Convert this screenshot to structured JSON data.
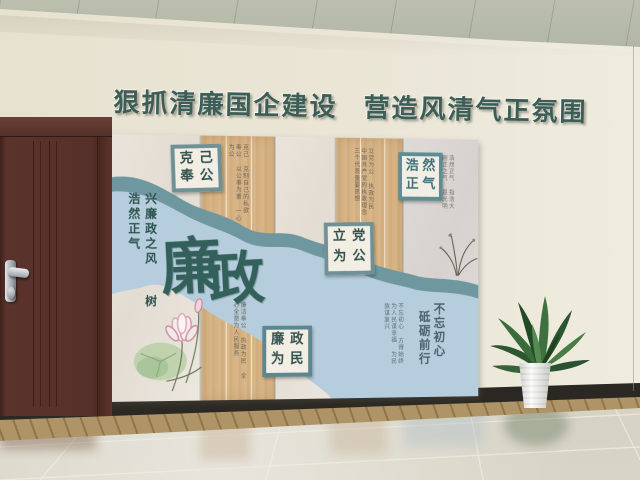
{
  "header": {
    "part1": "狠抓清廉国企建设",
    "part2": "营造风清气正氛围"
  },
  "mural": {
    "title": {
      "char1": "廉",
      "char2": "政"
    },
    "left_slogan": {
      "col1": "兴廉政之风",
      "col2": "树浩然正气"
    },
    "boxes": {
      "keji": {
        "chars": [
          "克",
          "己",
          "奉",
          "公"
        ],
        "note": "克己 克制自己的私欲 奉公 以公事为重 一心为公"
      },
      "haoran": {
        "chars": [
          "浩",
          "然",
          "正",
          "气"
        ],
        "note": "浩然正气 指浩大刚正之气 是光明磊落之气"
      },
      "lidang": {
        "chars": [
          "立",
          "党",
          "为",
          "公"
        ],
        "note": "立党为公 执政为民 中国共产党的执政理念 三个代表重要思想"
      },
      "lianzheng": {
        "chars": [
          "廉",
          "政",
          "为",
          "民"
        ],
        "note": "廉洁奉公 执政为民 全心全意为人民服务"
      }
    },
    "bottom_slogan": {
      "col1": "不忘初心",
      "col2": "砥砺前行",
      "note": "不忘初心 方得始终 为人民谋幸福 为民族谋复兴"
    }
  },
  "colors": {
    "header_text": "#3c5e56",
    "river_light": "#b5cddc",
    "river_dark": "#6f97a0",
    "wood_panel": "#d5b285",
    "cream_panel": "#e8e2da",
    "box_border": "#6f9195",
    "door": "#56302a",
    "ceiling": "#b6baaa",
    "wall": "#eae5d5",
    "floor": "#cdc8b8",
    "baseboard": "#26231f",
    "plant_green": "#2f5c33"
  }
}
